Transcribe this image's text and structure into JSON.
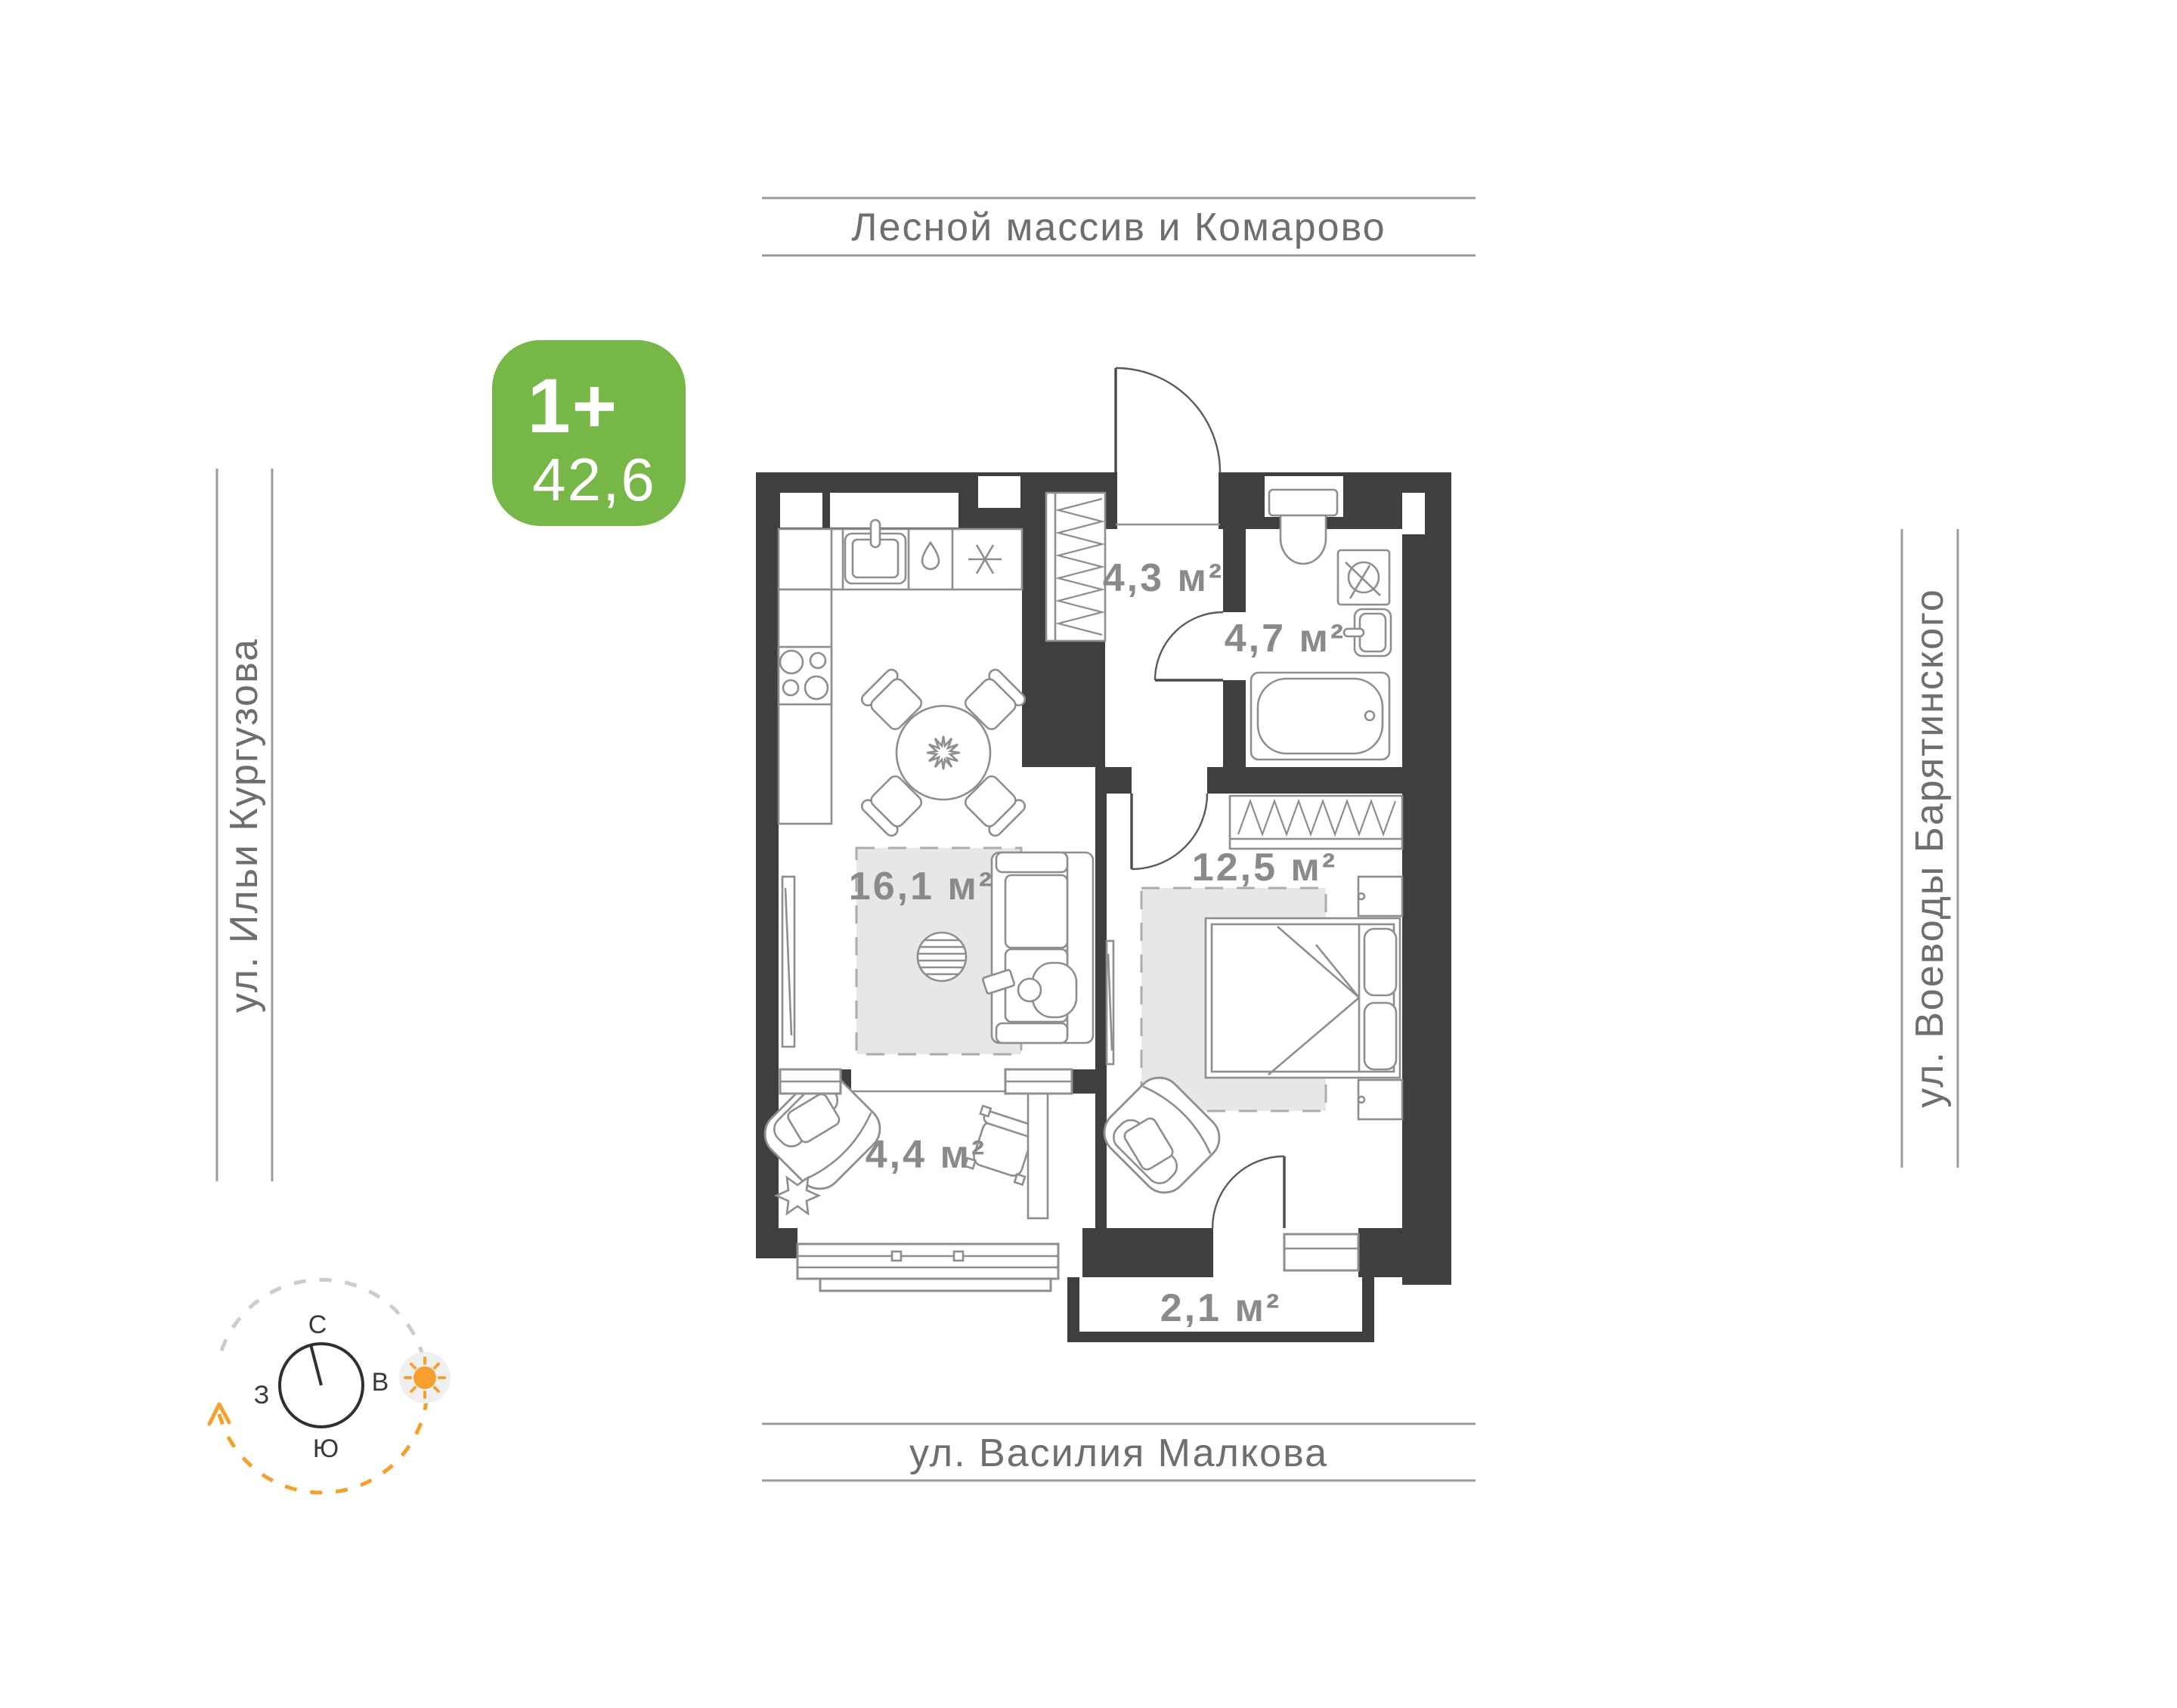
{
  "badge": {
    "rooms_label": "1+",
    "area_value": "42,6"
  },
  "streets": {
    "top": "Лесной массив и Комарово",
    "left": "ул. Ильи Кургузова",
    "right": "ул. Воеводы Барятинского",
    "bottom": "ул. Василия Малкова"
  },
  "plan": {
    "rooms": {
      "hallway": {
        "name": "прихожая",
        "area": "4,3 м²"
      },
      "bathroom": {
        "name": "санузел",
        "area": "4,7 м²"
      },
      "kitchen_living": {
        "name": "кухня-гостиная",
        "area": "16,1 м²"
      },
      "bedroom": {
        "name": "спальня",
        "area": "12,5 м²"
      },
      "loggia": {
        "name": "лоджия",
        "area": "4,4 м²"
      },
      "balcony": {
        "name": "балкон",
        "area": "2,1 м²"
      }
    }
  },
  "compass": {
    "north": "С",
    "east": "В",
    "west": "З",
    "south": "Ю"
  },
  "colors": {
    "wall": "#3e3f3f",
    "furniture": "#8e8e8e",
    "rug": "#e8e7e6",
    "room_label": "#8a8a8a",
    "street_text": "#6e6e6e",
    "street_line": "#9b9b9b",
    "badge_bg": "#76b747",
    "compass_orange": "#f5a02d",
    "compass_gray": "#cccccc",
    "sun_bg": "#efefef"
  }
}
